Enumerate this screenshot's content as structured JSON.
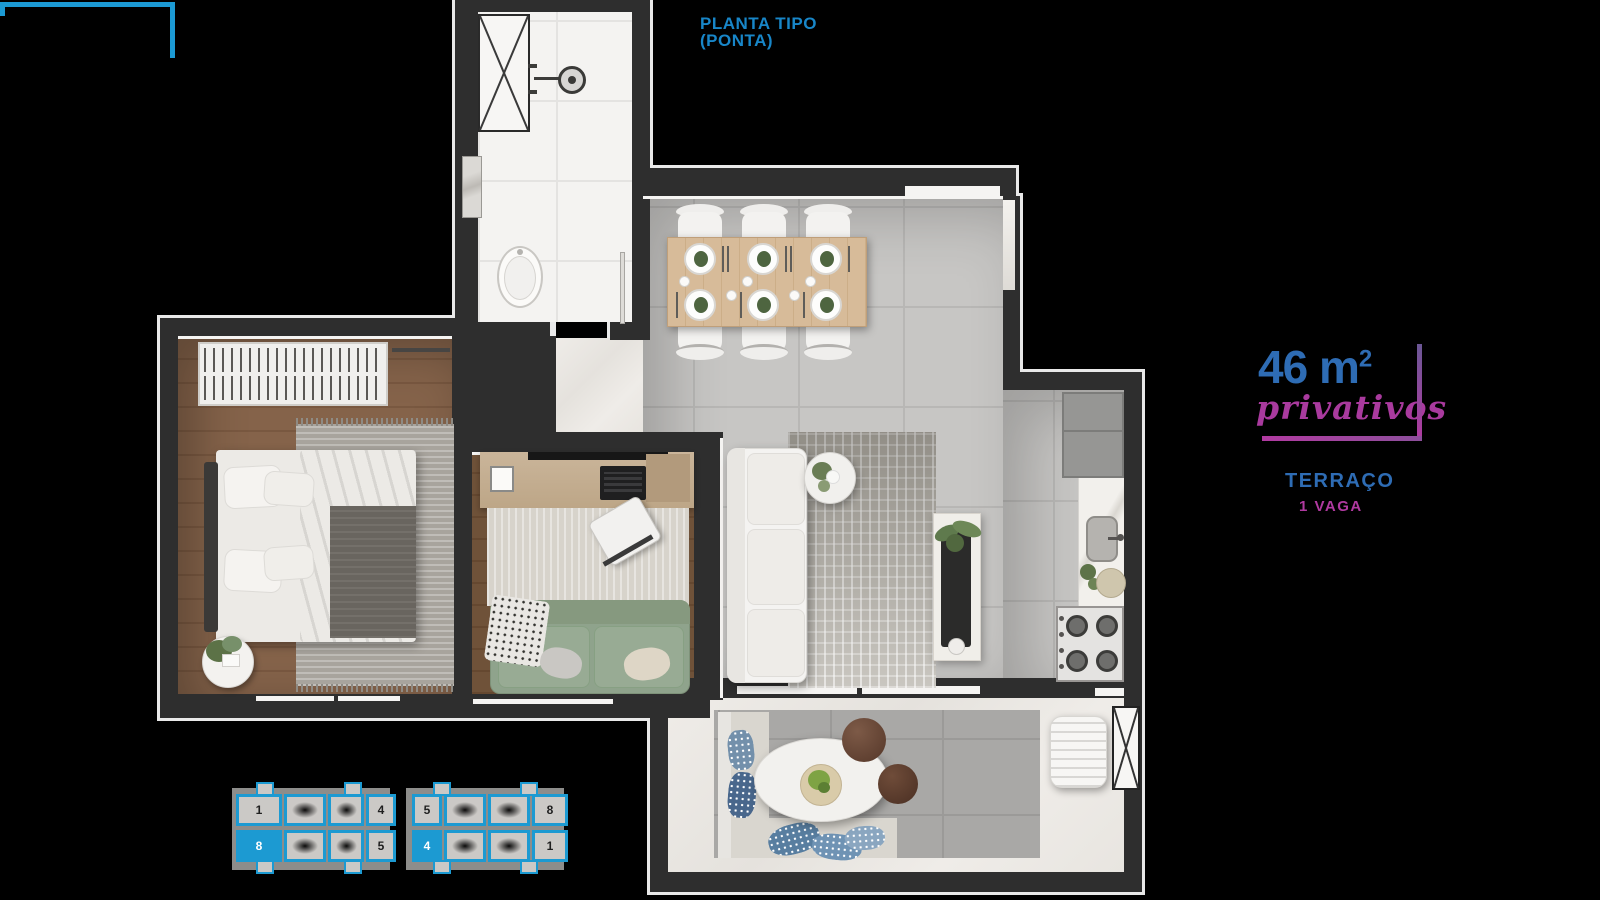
{
  "title_block": {
    "line1": "PLANTA TIPO",
    "line2": "(PONTA)"
  },
  "area_block": {
    "value": "46 m",
    "sup": "2",
    "qualifier": "privativos",
    "feature1": "TERRAÇO",
    "feature2": "1 VAGA"
  },
  "keyplan": {
    "units": [
      {
        "label": "1",
        "highlighted": false
      },
      {
        "label": "4",
        "highlighted": false
      },
      {
        "label": "5",
        "highlighted": false
      },
      {
        "label": "8",
        "highlighted": false
      },
      {
        "label": "8",
        "highlighted": true
      },
      {
        "label": "5",
        "highlighted": false
      },
      {
        "label": "4",
        "highlighted": true
      },
      {
        "label": "1",
        "highlighted": false
      }
    ]
  },
  "colors": {
    "label_blue": "#1886c8",
    "area_blue": "#2e6cb4",
    "magenta": "#b03aa0",
    "keyplan_blue": "#1c9ad2",
    "wall": "#2e2e2e",
    "background": "#000000"
  }
}
